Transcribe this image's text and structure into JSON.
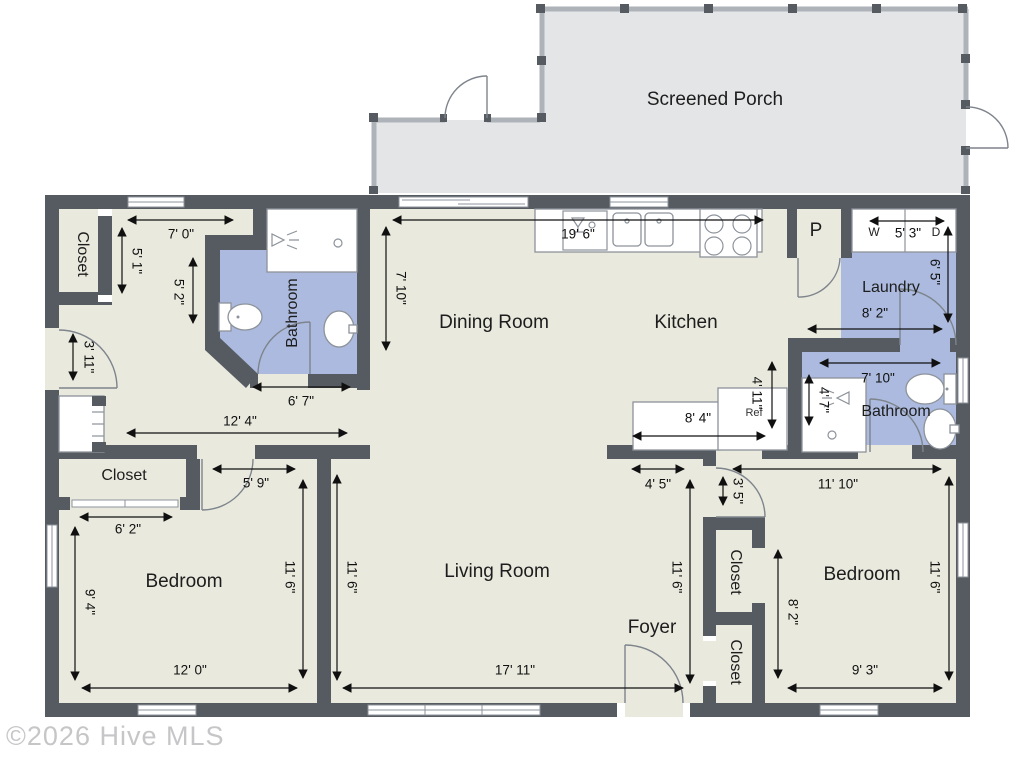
{
  "watermark": "©2026 Hive MLS",
  "rooms": {
    "screened_porch": "Screened Porch",
    "closet_tl": "Closet",
    "bathroom_master": "Bathroom",
    "dining": "Dining Room",
    "kitchen": "Kitchen",
    "pantry": "P",
    "laundry": "Laundry",
    "bathroom_hall": "Bathroom",
    "closet_bl": "Closet",
    "bedroom_left": "Bedroom",
    "living": "Living Room",
    "foyer": "Foyer",
    "closet_r1": "Closet",
    "closet_r2": "Closet",
    "bedroom_right": "Bedroom"
  },
  "appliances": {
    "washer": "W",
    "dryer": "D",
    "fridge": "Ref"
  },
  "dims": {
    "hall_w": "7' 0\"",
    "hall_h1": "5' 1\"",
    "hall_h2": "5' 2\"",
    "kitchen_w": "19' 6\"",
    "dining_h": "7' 10\"",
    "entry_door": "3' 11\"",
    "mbath_w": "6' 7\"",
    "dining_w": "12' 4\"",
    "counter_w": "8' 4\"",
    "kitchen_hall_h": "4' 11\"",
    "shower_h": "4' 7\"",
    "wd_w": "5' 3\"",
    "laundry_h": "6' 5\"",
    "laundry_w": "8' 2\"",
    "hbath_w": "7' 10\"",
    "foyer_w": "4' 5\"",
    "nook_h": "3' 5\"",
    "bed_r_top_w": "11' 10\"",
    "bed_hall_w": "5' 9\"",
    "closet_l_w": "6' 2\"",
    "bed_l_h1": "9' 4\"",
    "bed_l_h2": "11' 6\"",
    "bed_l_w": "12' 0\"",
    "living_h1": "11' 6\"",
    "living_w": "17' 11\"",
    "living_h2": "11' 6\"",
    "bed_r_h1": "8' 2\"",
    "bed_r_h2": "11' 6\"",
    "bed_r_w": "9' 3\""
  },
  "colors": {
    "wall": "#565b62",
    "floor": "#e9e9de",
    "porch_floor": "#e4e5e7",
    "porch_wall": "#aeb2b9",
    "wet_room": "#abbade",
    "dim": "#101010",
    "watermark_gray": "#c6c6c8"
  }
}
